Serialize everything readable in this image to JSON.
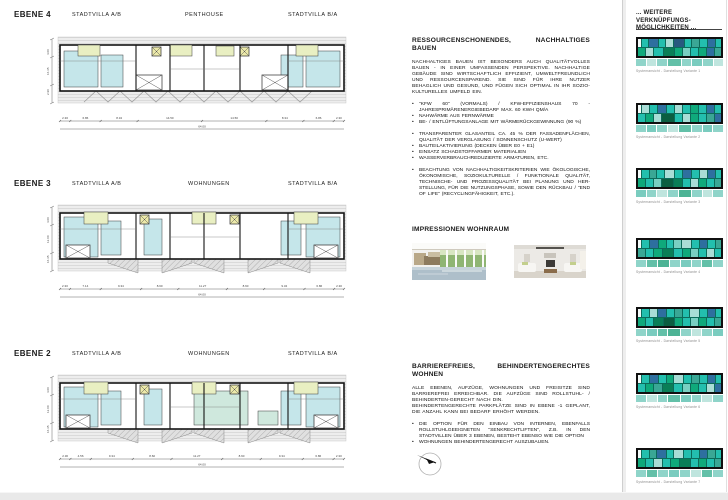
{
  "levels": [
    {
      "id": "e4",
      "label": "EBENE 4",
      "units": [
        "STADTVILLA A/B",
        "PENTHOUSE",
        "STADTVILLA B/A"
      ],
      "dims": [
        "2.30",
        "6.86",
        "8.34",
        "14.50",
        "14.50",
        "8.34",
        "6.86",
        "2.30"
      ],
      "total": "64.00",
      "side_dims": [
        "2.90",
        "16.35",
        "4.00"
      ],
      "style": "penthouse"
    },
    {
      "id": "e3",
      "label": "EBENE 3",
      "units": [
        "STADTVILLA A/B",
        "WOHNUNGEN",
        "STADTVILLA B/A"
      ],
      "dims": [
        "2.30",
        "7.14",
        "9.34",
        "8.60",
        "11.27",
        "8.60",
        "9.34",
        "6.86",
        "2.30"
      ],
      "total": "64.00",
      "side_dims": [
        "16.35",
        "12.00",
        "4.00"
      ],
      "style": "flats"
    },
    {
      "id": "e2",
      "label": "EBENE 2",
      "units": [
        "STADTVILLA A/B",
        "WOHNUNGEN",
        "STADTVILLA B/A"
      ],
      "dims": [
        "2.30",
        "4.56",
        "9.34",
        "8.60",
        "11.27",
        "8.60",
        "9.34",
        "6.86",
        "2.30"
      ],
      "total": "64.00",
      "side_dims": [
        "16.35",
        "12.00",
        "4.00"
      ],
      "style": "flats-green"
    }
  ],
  "sustain": {
    "title": "RESSOURCENSCHONENDES, NACHHALTIGES BAUEN",
    "intro": "NACHHALTIGES BAUEN IST BESONDERS AUCH QUALITÄTVOLLES BAUEN - IN EINER UMFASSENDEN PERSPEKTIVE. NACHHALTIGE GEBÄUDE SIND WIRTSCHAFTLICH EFFIZIENT, UMWELTFREUNDLICH UND RESSOURCENSPAREND. SIE SIND FÜR IHRE NUTZER BEHAGLICH UND GESUND, UND FÜGEN SICH OPTIMAL IN IHR SOZIO-KULTURELLES UMFELD EIN.",
    "bullets_energy": [
      "\"KFW 60\" (VORMALS) / KFW-EFFIZIENSHAUS 70 - JAHRESPRIMÄRENERGIEBEDARF MAX. 60 KWH QM/A",
      "NAHWÄRME AUS FERNWÄRME",
      "BE- / ENTLÜFTUNGSANLAGE MIT WÄRMERÜCKGEWINNUNG (90 %)"
    ],
    "bullets_material": [
      "TRANSPARENTER GLASANTEIL CA. 45 % DER FASSADENFLÄCHEN, QUALITÄT DER VERGLASUNG / SONNENSCHUTZ (U-WERT)",
      "BAUTEILAKTIVIERUNG (DECKEN ÜBER E0 + E1)",
      "EINSATZ SCHADSTOFFARMER MATERIALIEN",
      "WASSERVERBRAUCHREDUZIERTE ARMATUREN, ETC."
    ],
    "bullets_criteria": [
      "BEACHTUNG VON NACHHALTIGKEITSKRITERIEN WIE ÖKOLOGISCHE, ÖKONOMISCHE, SOZIOKULTURELLE / FUNKTIONALE QUALITÄT, TECHNISCHE- UND PROZESSQUALITÄT BEI PLANUNG UND HER- STELLUNG, FÜR DIE NUTZUNGSPHASE, SOWIE DEN RÜCKBAU / \"END OF LIFE\" (RECYCLINGFÄHIGKEIT, ETC.)."
    ]
  },
  "impressions": {
    "title": "IMPRESSIONEN WOHNRAUM"
  },
  "barrier": {
    "title": "BARRIEREFREIES, BEHINDERTENGERECHTES WOHNEN",
    "paragraphs": [
      "ALLE EBENEN, AUFZÜGE, WOHNUNGEN UND FREISITZE SIND BARRIEREFREI ERREICHBAR. DIE AUFZÜGE SIND ROLLSTUHL- / BEHINDERTEN-GERECHT NACH DIN.",
      "BEHINDERTENGERECHTE PARKPLÄTZE SIND IN EBENE -1 GEPLANT, DIE ANZAHL KANN BEI BEDARF ERHÖHT WERDEN."
    ],
    "bullets": [
      "DIE OPTION FÜR DEN EINBAU VON INTERNEN, EBENFALLS ROLLSTUHLGEEIGNETEN \"SENKRECHTLIFTEN\", Z.B. IN DEN STADTVILLEN ÜBER 3 EBENEN, BESTEHT EBENSO WIE DIE OPTION",
      "WOHNUNGEN BEHINDERTENGERECHT AUSZUBAUEN."
    ]
  },
  "sidebar": {
    "title_line1": "... WEITERE VERKNÜPFUNGS-",
    "title_line2": "MÖGLICHKEITEN ...",
    "captions": [
      "Systemansicht - Darstellung Variante 1",
      "Systemansicht - Darstellung Variante 2",
      "Systemansicht - Darstellung Variante 3",
      "Systemansicht - Darstellung Variante 4",
      "Systemansicht - Darstellung Variante 5",
      "Systemansicht - Darstellung Variante 6",
      "Systemansicht - Darstellung Variante 7"
    ],
    "palette": {
      "W": "#f4fbfa",
      "T": "#23bfae",
      "M": "#3aa795",
      "G": "#0fa97b",
      "E": "#0a7e57",
      "N": "#0b5e41",
      "B": "#2e6f9f",
      "D": "#27597f",
      "L": "#a9ddd6",
      "P": "#79cfc2",
      "pT": "#8fd4c9",
      "pG": "#63c0a8",
      "pL": "#bfe5de",
      "pM": "#7accbf",
      "pE": "#4db395"
    },
    "panels": [
      {
        "rows": [
          [
            "W",
            0.4
          ],
          [
            "T",
            1
          ],
          [
            "B",
            1.2
          ],
          [
            "T",
            1
          ],
          [
            "L",
            1
          ],
          [
            "D",
            1.4
          ],
          [
            "T",
            1
          ],
          [
            "M",
            1
          ],
          [
            "T",
            1
          ],
          [
            "B",
            1
          ],
          [
            "T",
            0.8
          ]
        ],
        "rows2": [
          [
            "G",
            1
          ],
          [
            "L",
            1
          ],
          [
            "T",
            1.2
          ],
          [
            "E",
            1.4
          ],
          [
            "G",
            1
          ],
          [
            "P",
            1
          ],
          [
            "T",
            1
          ],
          [
            "G",
            1
          ],
          [
            "B",
            1
          ],
          [
            "M",
            0.8
          ]
        ],
        "band": [
          [
            "pT",
            1
          ],
          [
            "pL",
            1
          ],
          [
            "pT",
            1
          ],
          [
            "pG",
            1.4
          ],
          [
            "pT",
            1
          ],
          [
            "pM",
            1
          ],
          [
            "pT",
            1
          ],
          [
            "pL",
            1
          ]
        ]
      },
      {
        "rows": [
          [
            "W",
            0.4
          ],
          [
            "L",
            1
          ],
          [
            "T",
            1
          ],
          [
            "B",
            1.2
          ],
          [
            "T",
            1
          ],
          [
            "L",
            1
          ],
          [
            "T",
            1
          ],
          [
            "G",
            1
          ],
          [
            "T",
            1
          ],
          [
            "B",
            1
          ],
          [
            "T",
            0.8
          ]
        ],
        "rows2": [
          [
            "T",
            1
          ],
          [
            "G",
            1
          ],
          [
            "L",
            1
          ],
          [
            "N",
            1.6
          ],
          [
            "T",
            1
          ],
          [
            "L",
            1
          ],
          [
            "G",
            1
          ],
          [
            "T",
            1
          ],
          [
            "M",
            1
          ],
          [
            "B",
            0.8
          ]
        ],
        "band": [
          [
            "pT",
            1
          ],
          [
            "pM",
            1
          ],
          [
            "pT",
            1
          ],
          [
            "pL",
            1
          ],
          [
            "pG",
            1.3
          ],
          [
            "pT",
            1
          ],
          [
            "pM",
            1
          ],
          [
            "pT",
            1
          ]
        ]
      },
      {
        "rows": [
          [
            "W",
            0.4
          ],
          [
            "T",
            1
          ],
          [
            "M",
            1
          ],
          [
            "T",
            1
          ],
          [
            "L",
            1.3
          ],
          [
            "T",
            1
          ],
          [
            "B",
            1.2
          ],
          [
            "T",
            1
          ],
          [
            "L",
            1
          ],
          [
            "B",
            1
          ],
          [
            "T",
            0.8
          ]
        ],
        "rows2": [
          [
            "G",
            1
          ],
          [
            "T",
            1
          ],
          [
            "P",
            1
          ],
          [
            "N",
            1.5
          ],
          [
            "E",
            1.2
          ],
          [
            "T",
            1
          ],
          [
            "L",
            1
          ],
          [
            "G",
            1
          ],
          [
            "T",
            1
          ],
          [
            "M",
            0.8
          ]
        ],
        "band": [
          [
            "pM",
            1
          ],
          [
            "pT",
            1
          ],
          [
            "pL",
            1
          ],
          [
            "pT",
            1
          ],
          [
            "pE",
            1.3
          ],
          [
            "pT",
            1
          ],
          [
            "pL",
            1
          ],
          [
            "pT",
            1
          ]
        ]
      },
      {
        "rows": [
          [
            "W",
            0.4
          ],
          [
            "T",
            1
          ],
          [
            "B",
            1.2
          ],
          [
            "G",
            1
          ],
          [
            "T",
            1
          ],
          [
            "P",
            1
          ],
          [
            "L",
            1.3
          ],
          [
            "T",
            1
          ],
          [
            "B",
            1
          ],
          [
            "T",
            1
          ],
          [
            "M",
            0.8
          ]
        ],
        "rows2": [
          [
            "M",
            1
          ],
          [
            "T",
            1
          ],
          [
            "G",
            1
          ],
          [
            "E",
            1.5
          ],
          [
            "T",
            1
          ],
          [
            "G",
            1
          ],
          [
            "P",
            1
          ],
          [
            "T",
            1
          ],
          [
            "L",
            1
          ],
          [
            "T",
            0.8
          ]
        ],
        "band": [
          [
            "pT",
            1
          ],
          [
            "pG",
            1
          ],
          [
            "pE",
            1.2
          ],
          [
            "pT",
            1
          ],
          [
            "pM",
            1
          ],
          [
            "pT",
            1
          ],
          [
            "pG",
            1
          ],
          [
            "pT",
            1
          ]
        ]
      },
      {
        "rows": [
          [
            "W",
            0.4
          ],
          [
            "T",
            1
          ],
          [
            "L",
            1
          ],
          [
            "B",
            1.2
          ],
          [
            "T",
            1
          ],
          [
            "M",
            1
          ],
          [
            "T",
            1
          ],
          [
            "L",
            1.2
          ],
          [
            "T",
            1
          ],
          [
            "B",
            1
          ],
          [
            "T",
            0.8
          ]
        ],
        "rows2": [
          [
            "G",
            1
          ],
          [
            "T",
            1
          ],
          [
            "E",
            1.2
          ],
          [
            "N",
            1.5
          ],
          [
            "G",
            1
          ],
          [
            "T",
            1
          ],
          [
            "P",
            1
          ],
          [
            "G",
            1
          ],
          [
            "T",
            1
          ],
          [
            "M",
            0.8
          ]
        ],
        "band": [
          [
            "pT",
            1
          ],
          [
            "pM",
            1
          ],
          [
            "pG",
            1
          ],
          [
            "pE",
            1.2
          ],
          [
            "pT",
            1
          ],
          [
            "pL",
            1
          ],
          [
            "pT",
            1
          ],
          [
            "pM",
            1
          ]
        ]
      },
      {
        "rows": [
          [
            "W",
            0.4
          ],
          [
            "T",
            1
          ],
          [
            "B",
            1.2
          ],
          [
            "T",
            1
          ],
          [
            "G",
            1
          ],
          [
            "L",
            1.3
          ],
          [
            "T",
            1
          ],
          [
            "M",
            1
          ],
          [
            "T",
            1
          ],
          [
            "B",
            1
          ],
          [
            "T",
            0.8
          ]
        ],
        "rows2": [
          [
            "T",
            1
          ],
          [
            "G",
            1
          ],
          [
            "M",
            1
          ],
          [
            "E",
            1.5
          ],
          [
            "T",
            1
          ],
          [
            "P",
            1
          ],
          [
            "G",
            1
          ],
          [
            "T",
            1
          ],
          [
            "L",
            1
          ],
          [
            "B",
            0.8
          ]
        ],
        "band": [
          [
            "pT",
            1
          ],
          [
            "pL",
            1
          ],
          [
            "pT",
            1
          ],
          [
            "pG",
            1.2
          ],
          [
            "pM",
            1
          ],
          [
            "pT",
            1
          ],
          [
            "pL",
            1
          ],
          [
            "pT",
            1
          ]
        ]
      },
      {
        "rows": [
          [
            "W",
            0.4
          ],
          [
            "T",
            1
          ],
          [
            "M",
            1
          ],
          [
            "B",
            1.2
          ],
          [
            "T",
            1
          ],
          [
            "L",
            1.3
          ],
          [
            "T",
            1
          ],
          [
            "T",
            1
          ],
          [
            "B",
            1
          ],
          [
            "M",
            1
          ],
          [
            "T",
            0.8
          ]
        ],
        "rows2": [
          [
            "G",
            1
          ],
          [
            "T",
            1
          ],
          [
            "L",
            1
          ],
          [
            "T",
            1
          ],
          [
            "G",
            1.2
          ],
          [
            "E",
            1.3
          ],
          [
            "T",
            1
          ],
          [
            "G",
            1
          ],
          [
            "T",
            1
          ],
          [
            "M",
            0.8
          ]
        ],
        "band": [
          [
            "pT",
            1
          ],
          [
            "pG",
            1
          ],
          [
            "pT",
            1
          ],
          [
            "pM",
            1
          ],
          [
            "pT",
            1
          ],
          [
            "pL",
            1
          ],
          [
            "pG",
            1
          ],
          [
            "pT",
            1
          ]
        ]
      }
    ]
  },
  "plan_colors": {
    "cyan": "#c5e6ea",
    "lime": "#e9efc2",
    "green": "#cfe8dd",
    "yellow": "#ece9a9",
    "band": "#ededed",
    "band_line": "#d3d3d3",
    "hatch": "#e0e0e0",
    "hatch_line": "#aeaeae",
    "wall": "#141414"
  }
}
